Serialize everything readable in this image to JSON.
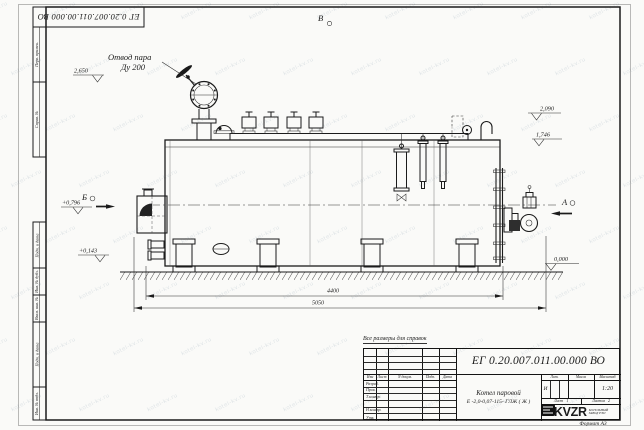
{
  "sheet": {
    "top_stamp": "ЕГ 0.20.007.011.00.000  ВО",
    "watermark": "kotel-kv.ru",
    "side_labels": {
      "perv": "Перв. примен.",
      "sprav": "Справ. №",
      "podp1": "Подп. и дата",
      "inv_dubl": "Инв. № дубл.",
      "vzam": "Взам. инв. №",
      "podp2": "Подп. и дата",
      "inv_podl": "Инв. № подл."
    }
  },
  "drawing": {
    "callout_line1": "Отвод пара",
    "callout_line2": "Ду 200",
    "view_top": "В",
    "view_left": "Б",
    "view_right": "А",
    "elev_2650": "2,650",
    "elev_2090": "2,090",
    "elev_1746": "1,746",
    "elev_0796": "+0,796",
    "elev_0143": "+0,143",
    "elev_0000": "0,000",
    "dim_4400": "4400",
    "dim_5050": "5050",
    "note": "Все размеры для справок"
  },
  "title_block": {
    "doc_number": "ЕГ 0.20.007.011.00.000  ВО",
    "name_line1": "Котел паровой",
    "name_line2": "Е -2,0-0,07-115- ГЛЖ ( Ж )",
    "col_izm": "Изм",
    "col_list": "Лист",
    "col_doc": "N докум.",
    "col_podp": "Подп.",
    "col_data": "Дата",
    "row_razrab": "Разраб.",
    "row_prov": "Пров.",
    "row_tkontr": "Т.контр.",
    "row_nkontr": "Н.контр.",
    "row_utv": "Утв.",
    "lit_label": "Лит.",
    "lit_value": "И",
    "mass_label": "Масса",
    "scale_label": "Масштаб",
    "scale_value": "1:20",
    "sheet_label": "Лист",
    "sheet_value": "1",
    "sheets_label": "Листов",
    "sheets_value": "2",
    "logo_text": "KVZR",
    "logo_sub1": "КОТЕЛЬНЫЙ",
    "logo_sub2": "ЗАВОД РЭП",
    "format_label": "Формат А3"
  }
}
